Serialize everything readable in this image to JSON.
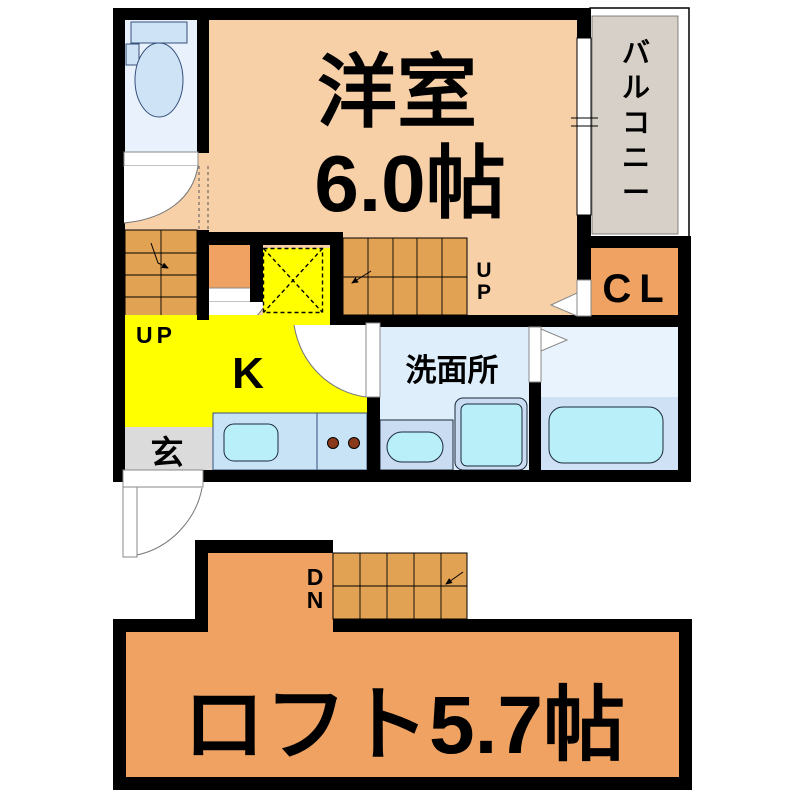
{
  "plan": {
    "labels": {
      "room": "洋室",
      "room_size": "6.0帖",
      "balcony": [
        "バ",
        "ル",
        "コ",
        "ニ",
        "ー"
      ],
      "closet": "CL",
      "up_left": "UP",
      "up_right": [
        "U",
        "P"
      ],
      "kitchen": "K",
      "entrance": "玄",
      "washroom": "洗面所",
      "down": [
        "D",
        "N"
      ],
      "loft": "ロフト5.7帖"
    },
    "colors": {
      "wall": "#000000",
      "western_room": "#f7d0a8",
      "stairs": "#e1a254",
      "closet_loft_orange": "#efa261",
      "kitchen_yellow": "#ffff00",
      "balcony_gray": "#d7d0c8",
      "entrance_gray": "#dbdbdb",
      "toilet_room": "#e9f2fc",
      "washroom_blue": "#dfeefb",
      "bath_lower_blue": "#cfe1f5",
      "fixture_cyan": "#b9eff8",
      "counter_blue": "#c9e3f6",
      "burner_brown": "#8a3a1a"
    }
  }
}
